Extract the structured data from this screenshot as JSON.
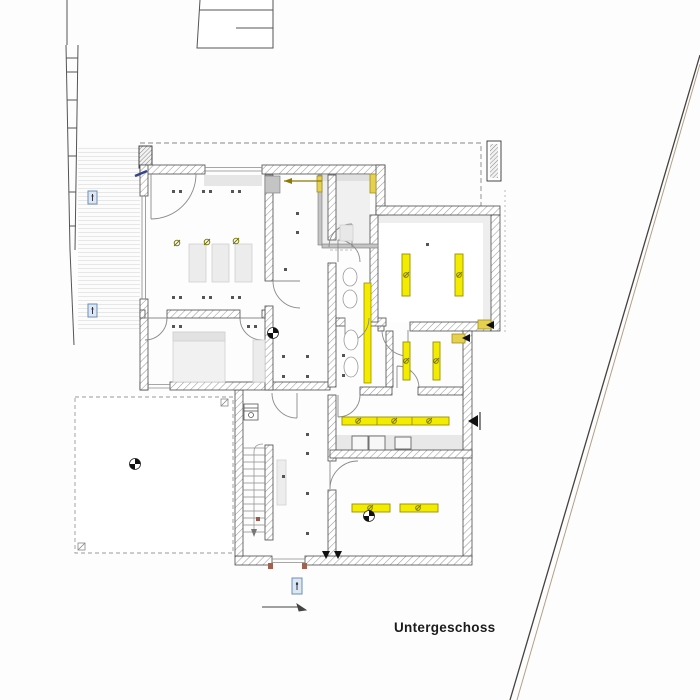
{
  "title": {
    "label": "Untergeschoss"
  },
  "colors": {
    "highlight_yellow": "#f4ec00",
    "highlight_yellow_border": "#9a8f00",
    "lintel_yellow": "#e6d14e",
    "wall_hatch_gray": "#9a9a9a",
    "wall_edge": "#4a4a4a",
    "partition_gray": "#c4c4c4",
    "floor_gray": "#efefef",
    "marker_blue_border": "#6c8eb8",
    "marker_blue_fill": "#dde7f2",
    "window_anchor_brown": "#a2614f",
    "boundary_dark": "#45423e",
    "boundary_tan": "#b3a088",
    "dim_olive": "#8a7a00",
    "ink": "#1c1c1c"
  },
  "symbols": {
    "survey_point": "quartered-circle",
    "light_fixture": "yellow-bar",
    "lamp": "circle-with-slash",
    "ceiling_spot": "paired-dots",
    "section_marker": "filled-triangle",
    "plan_marker": "small-blue-stamp"
  }
}
